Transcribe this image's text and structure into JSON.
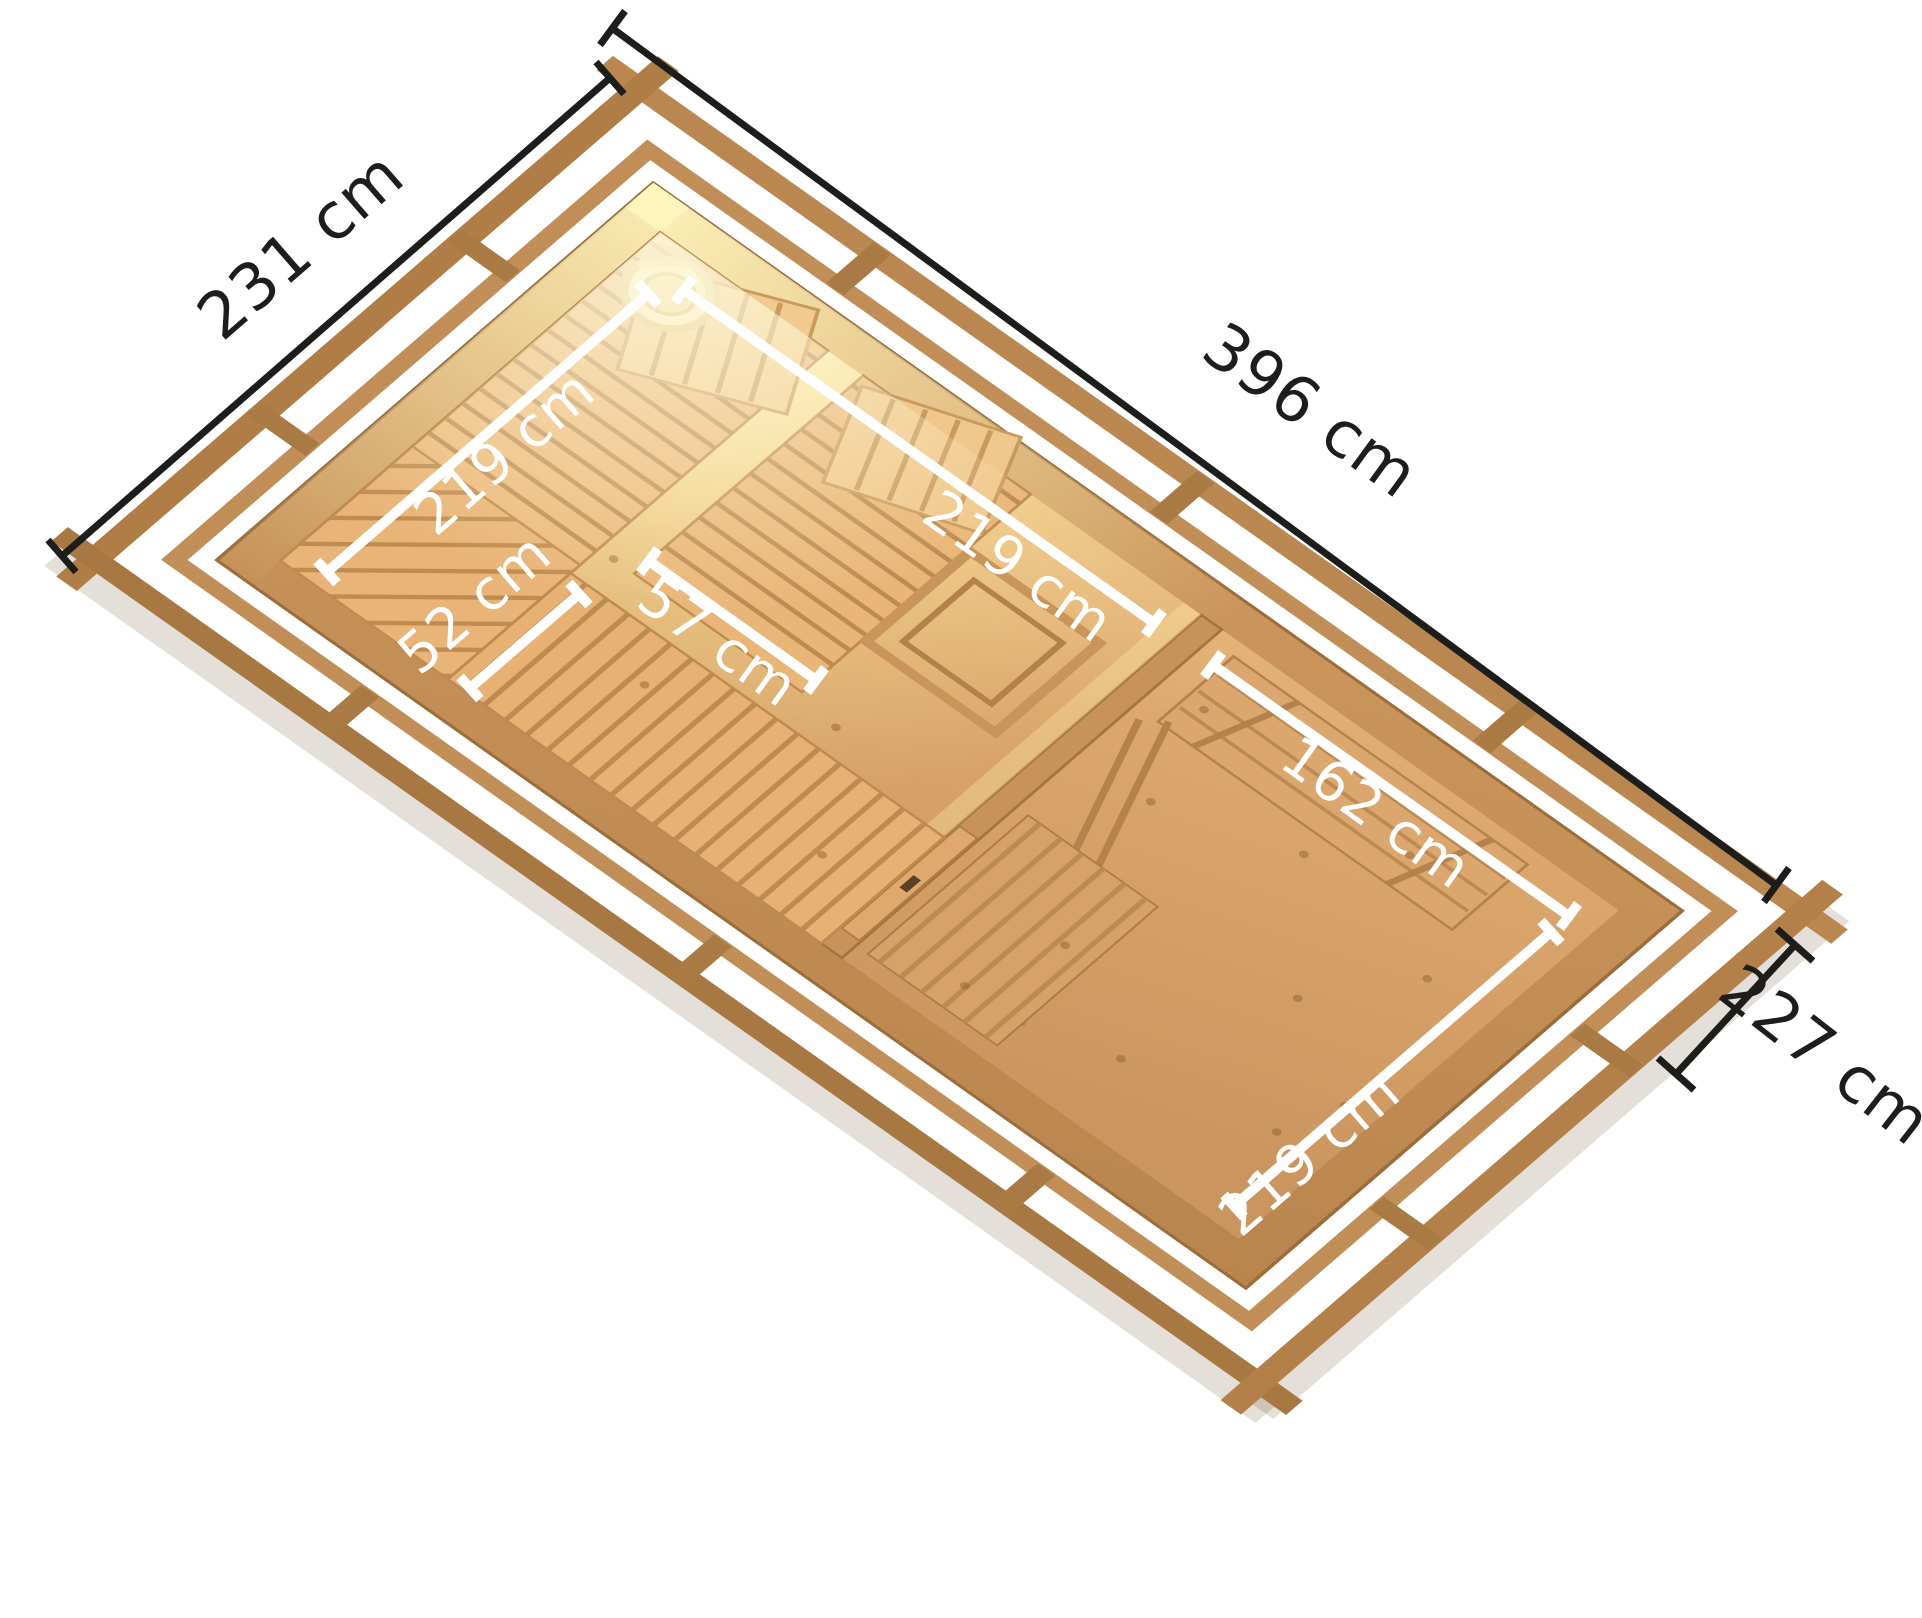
{
  "figure": {
    "kind": "sauna-floorplan-top-view",
    "units": "cm"
  },
  "dims": {
    "building_width": {
      "label": "231 cm",
      "value": 231
    },
    "building_length": {
      "label": "396 cm",
      "value": 396
    },
    "side_depth": {
      "label": "227 cm",
      "value": 227
    },
    "sauna_room_width": {
      "label": "219 cm",
      "value": 219
    },
    "sauna_room_length": {
      "label": "219 cm",
      "value": 219
    },
    "bench_upper_depth": {
      "label": "57 cm",
      "value": 57
    },
    "bench_lower_depth": {
      "label": "52 cm",
      "value": 52
    },
    "anteroom_length": {
      "label": "162 cm",
      "value": 162
    },
    "anteroom_width": {
      "label": "219 cm",
      "value": 219
    }
  },
  "colors": {
    "dim_black": "#1d1d1b",
    "dim_white": "#ffffff",
    "beam": "#b5834e",
    "beam_dark": "#a87843",
    "wall": "#c8935a",
    "floor": "#d9a569",
    "bench": "#ecb97c",
    "glow": "#fff3b8"
  }
}
